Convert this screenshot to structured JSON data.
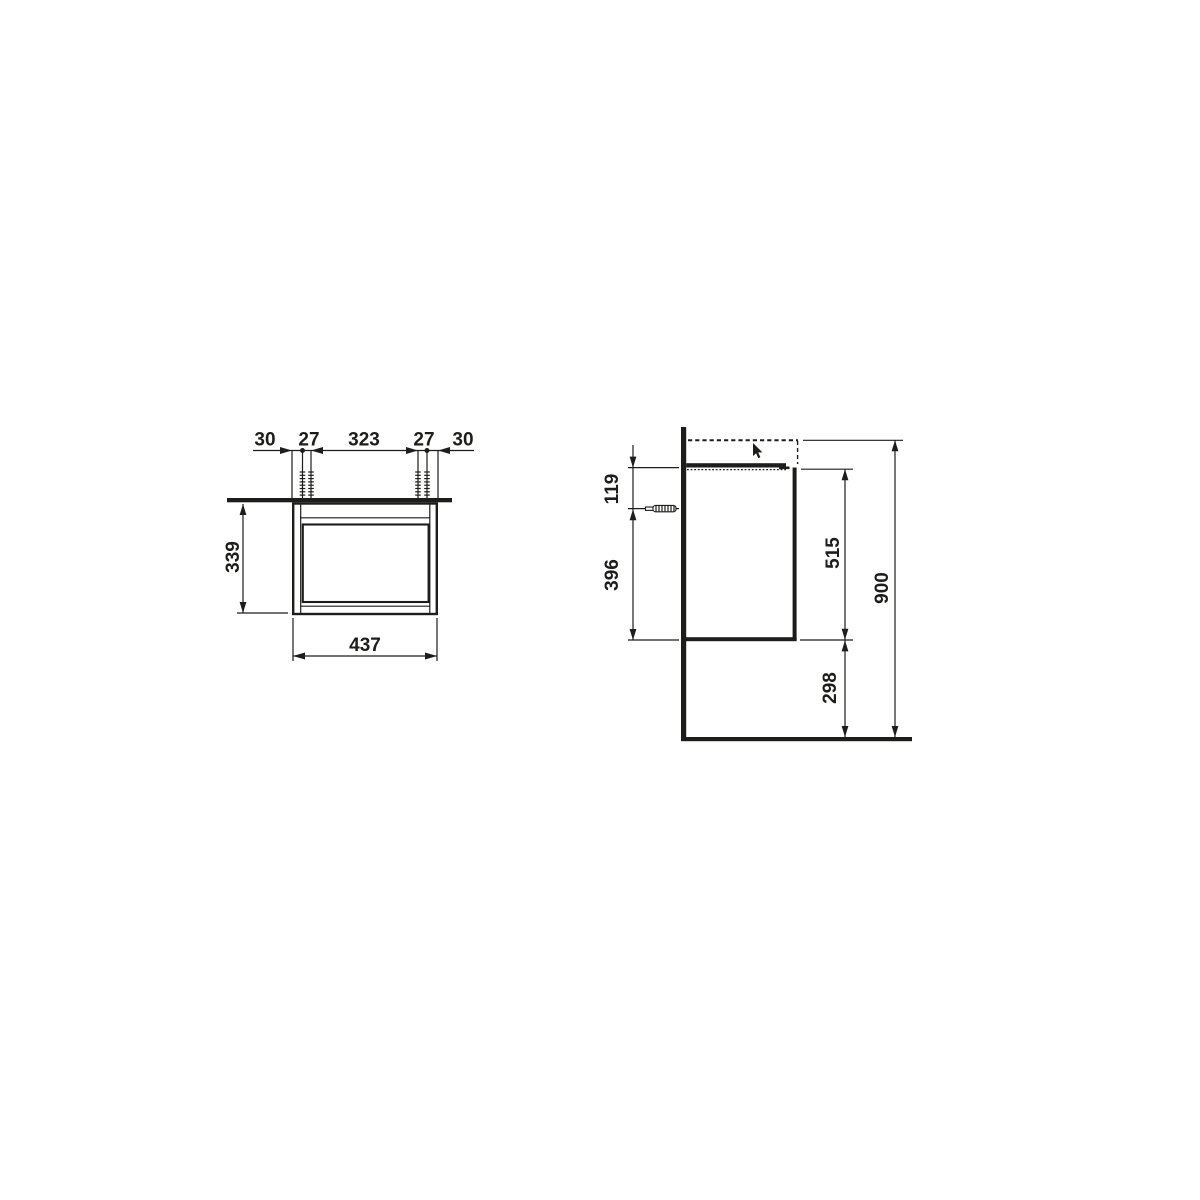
{
  "colors": {
    "line": "#1d1d1b",
    "background": "#ffffff"
  },
  "front_view": {
    "label_offset_left": "30",
    "label_fixing_left": "27",
    "label_fixing_span": "323",
    "label_fixing_right": "27",
    "label_offset_right": "30",
    "label_height": "339",
    "label_width": "437"
  },
  "side_view": {
    "label_top_offset": "119",
    "label_lower_span": "396",
    "label_body_height": "515",
    "label_floor_clearance": "298",
    "label_total_height": "900"
  },
  "icons": {
    "cursor": "mouse-pointer",
    "wall_plug": "mounting-screw"
  }
}
